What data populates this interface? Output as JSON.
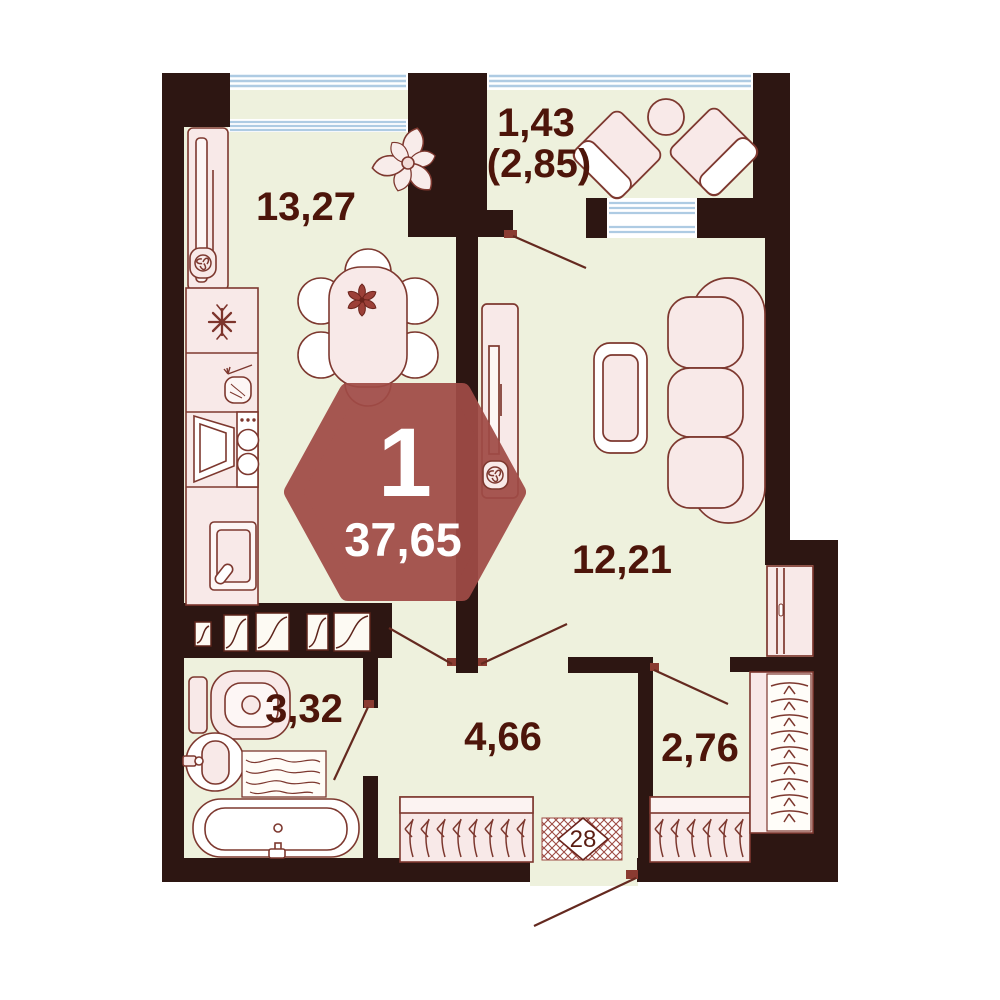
{
  "plan": {
    "type": "apartment-floor-plan",
    "unit_badge": {
      "rooms_count": "1",
      "total_area": "37,65"
    },
    "entrance": {
      "apartment_number": "28"
    },
    "rooms": {
      "kitchen": {
        "area": "13,27"
      },
      "balcony": {
        "area": "1,43",
        "area_total": "(2,85)"
      },
      "living": {
        "area": "12,21"
      },
      "bathroom": {
        "area": "3,32"
      },
      "hallway": {
        "area": "4,66"
      },
      "wardrobe": {
        "area": "2,76"
      }
    },
    "colors": {
      "wall": "#2d1612",
      "floor": "#eef1dd",
      "furniture_fill": "#f8e9e8",
      "furniture_stroke": "#7d382f",
      "window_blue": "#aecbe3",
      "badge_accent": "#a04b46",
      "label_text": "#4d150a"
    }
  }
}
